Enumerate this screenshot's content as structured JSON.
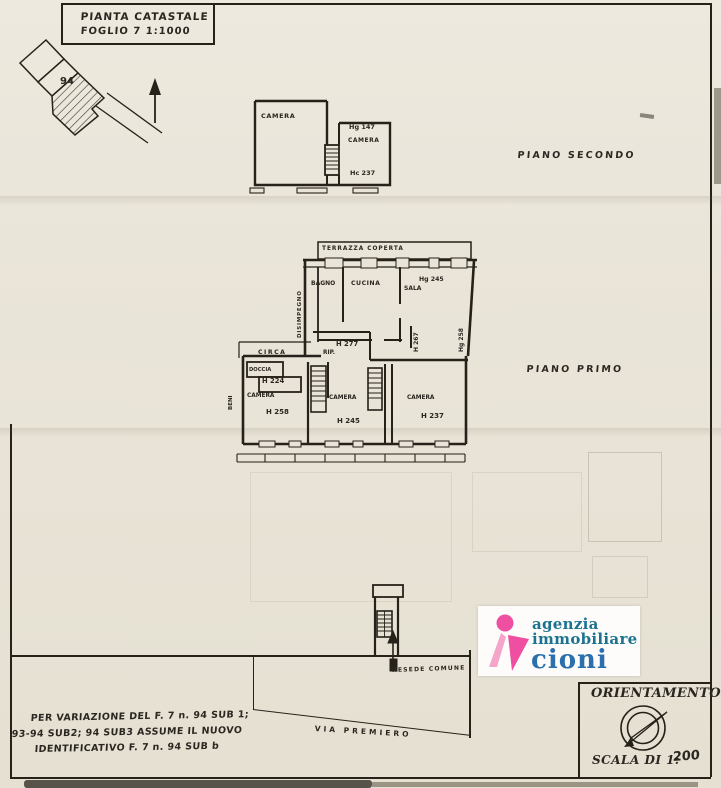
{
  "colors": {
    "paper": "#e9e4d7",
    "ink": "#262119",
    "logo_pink": "#ee4fa0",
    "logo_pink_light": "#f4a6ca",
    "logo_teal": "#1c7390",
    "logo_blue": "#2b6fad"
  },
  "title_box": {
    "line1": "PIANTA CATASTALE",
    "line2": "FOGLIO 7 1:1000"
  },
  "parcel_map": {
    "parcel_number": "94"
  },
  "piano_secondo": {
    "floor_label": "PIANO SECONDO",
    "camera_left": "CAMERA",
    "height_note_1": "Hg 147",
    "camera_right": "CAMERA",
    "height_note_2": "Hc 237"
  },
  "piano_primo": {
    "floor_label": "PIANO PRIMO",
    "terrazza": "TERRAZZA COPERTA",
    "bagno": "BAGNO",
    "cucina": "CUCINA",
    "sala": "SALA",
    "sala_height": "Hg 245",
    "disimpegno": "DISIMPEGNO",
    "h277": "H 277",
    "rip": "RIP.",
    "circa": "CIRCA",
    "doccia": "DOCCIA",
    "h224": "H 224",
    "camera_1": "CAMERA",
    "camera_1_height": "H 258",
    "camera_2": "CAMERA",
    "camera_2_height": "H 245",
    "camera_3": "CAMERA",
    "camera_3_height": "H 237",
    "side_height_1": "H 267",
    "side_height_2": "Hg 258",
    "side_label": "BENI"
  },
  "piano_terra": {
    "resede": "RESEDE COMUNE",
    "via": "VIA PREMIERO"
  },
  "note": {
    "line1": "PER VARIAZIONE DEL F. 7 n. 94 SUB 1;",
    "line2": "93-94 SUB2; 94 SUB3 ASSUME IL NUOVO",
    "line3": "IDENTIFICATIVO F. 7 n. 94 SUB b"
  },
  "agency_logo": {
    "line1": "agenzia",
    "line2": "immobiliare",
    "line3": "cioni"
  },
  "orientation": {
    "title": "ORIENTAMENTO",
    "scale_label": "SCALA DI 1:",
    "scale_value": "200"
  }
}
